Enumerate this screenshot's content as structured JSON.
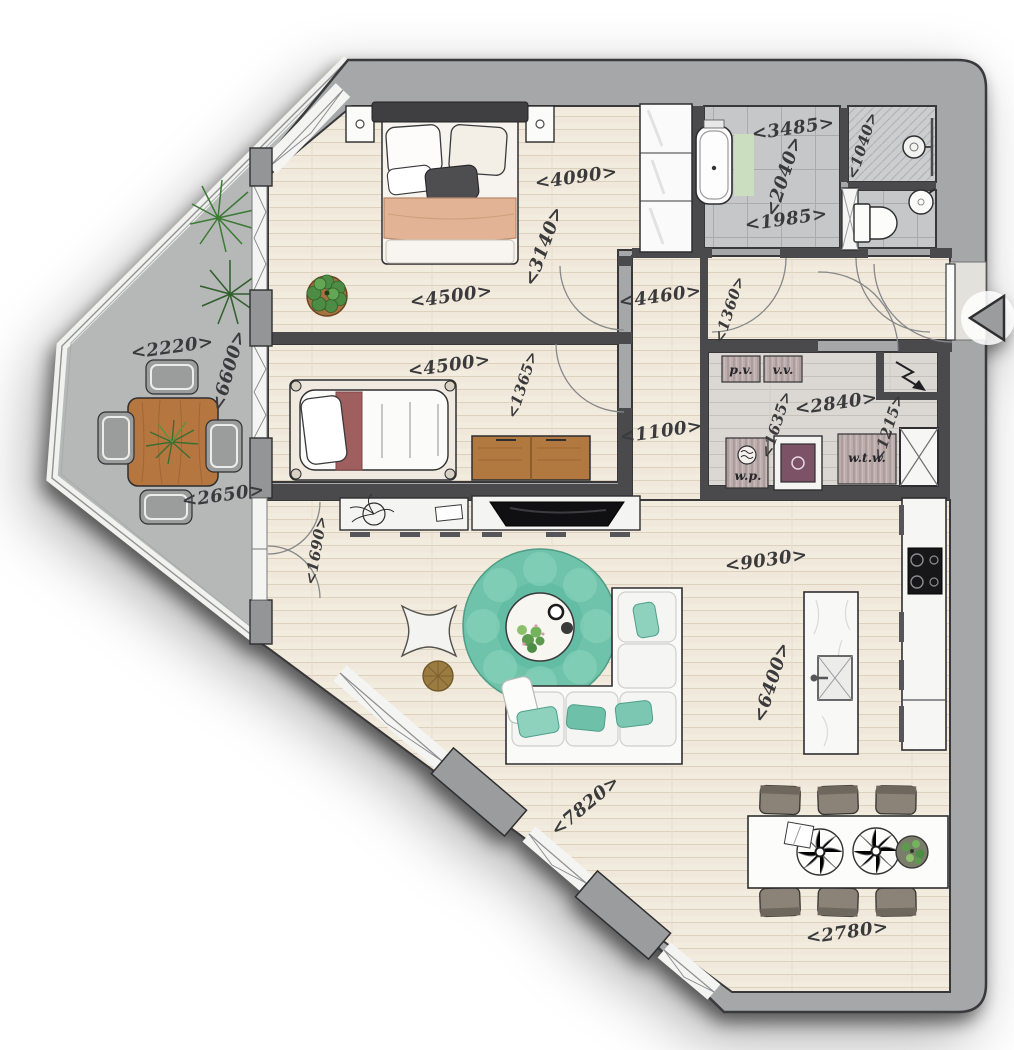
{
  "title": "Apartment floor plan (top-down architectural drawing)",
  "labels": {
    "bedroom1_top_width": "<4090>",
    "bedroom1_depth": "<3140>",
    "bedroom1_width": "<4500>",
    "hallway_length": "<4460>",
    "hallway_depth": "<1360>",
    "bathroom_width": "<3485>",
    "bathroom_depth": "<2040>",
    "bathroom_bottom_width": "<1985>",
    "shower_width": "<1040>",
    "balcony_top_width": "<2220>",
    "balcony_length": "<6600>",
    "balcony_bottom_width": "<2650>",
    "bedroom2_width": "<4500>",
    "bedroom2_depth": "<1365>",
    "hallway_width": "<1100>",
    "tech_room_width": "<2840>",
    "tech_room_depth": "<1635>",
    "shaft_depth": "<1215>",
    "balcony_door_width": "<1690>",
    "living_width": "<9030>",
    "living_depth": "<6400>",
    "living_diagonal_wall": "<7820>",
    "dining_wall_width": "<2780>",
    "unit_pv": "p.v.",
    "unit_vv": "v.v.",
    "unit_wp": "w.p.",
    "unit_wtw": "w.t.w."
  },
  "icons": {
    "entrance_arrow": "left-pointing triangle marking the entrance door",
    "electric_meter": "lightning-arrow symbol in meter closet",
    "shaft": "crossed box (duct shaft)",
    "shower_head": "circle with arm in shower corner"
  },
  "colors": {
    "exterior_wall": "#a5a7a9",
    "interior_wall": "#4a4a4d",
    "wood_floor": "#f2ecdf",
    "tech_floor": "#dbd8d3",
    "tile_floor": "#c5c7c8",
    "balcony_floor": "#b6b8b8",
    "rug_teal": "#6fc3aa",
    "furniture_wood": "#b1783f",
    "blanket_peach": "#e2b394",
    "pillow_red": "#9c5c5c",
    "bath_mat_green": "#ccdec0",
    "label_ink": "#3a3a3c"
  }
}
